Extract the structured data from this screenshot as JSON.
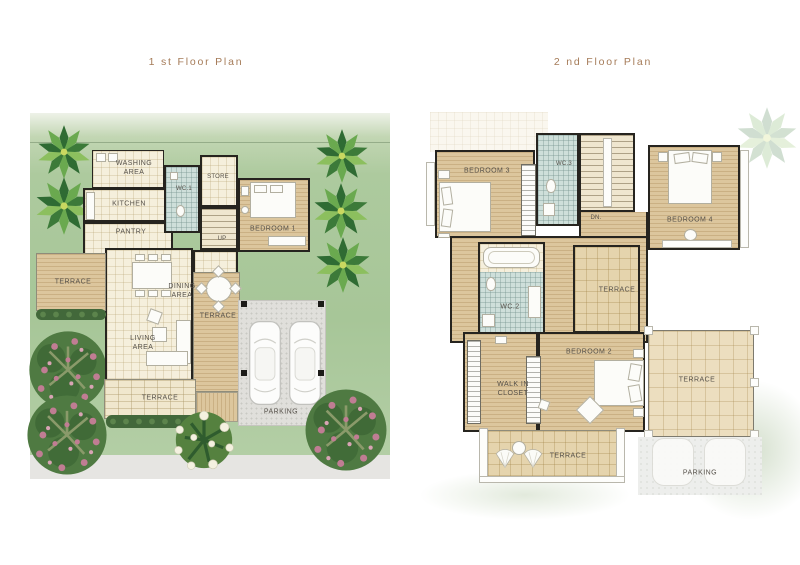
{
  "floor1": {
    "title": "1 st Floor Plan",
    "labels": {
      "washing": "WASHING\nAREA",
      "kitchen": "KITCHEN",
      "wc1": "WC.1",
      "store": "STORE",
      "up": "UP",
      "pantry": "PANTRY",
      "terrace_left": "TERRACE",
      "dining": "DINING\nAREA",
      "terrace_mid": "TERRACE",
      "living": "LIVING\nAREA",
      "bedroom1": "BEDROOM 1",
      "terrace_bottom": "TERRACE",
      "parking": "PARKING"
    }
  },
  "floor2": {
    "title": "2 nd Floor Plan",
    "labels": {
      "bedroom3": "BEDROOM 3",
      "wc3": "WC.3",
      "dn": "DN.",
      "bedroom4": "BEDROOM 4",
      "wc2": "WC.2",
      "terrace_mid": "TERRACE",
      "bedroom2": "BEDROOM 2",
      "walkin": "WALK IN\nCLOSET",
      "terrace_bottom": "TERRACE",
      "terrace_right": "TERRACE",
      "parking": "PARKING"
    }
  },
  "colors": {
    "title_text": "#a57b58",
    "label_text": "#56514a",
    "wall": "#26241f",
    "grass": "#a7c698",
    "floor_tile": "#f5efdc",
    "floor_wood": "#dcc69d",
    "floor_wc": "#cedfda",
    "paving": "#e0dfdb",
    "tree_green": "#4f7a42",
    "flower_pink": "#c07d93",
    "hedge_green": "#42683a"
  },
  "icons": {
    "trees": [
      "palm-tree-icon",
      "flowering-tree-icon",
      "white-flower-bush-icon"
    ],
    "furniture": [
      "bed-icon",
      "dining-table-icon",
      "sofa-icon",
      "round-table-icon",
      "car-icon",
      "bathtub-icon",
      "toilet-icon",
      "stairs-icon",
      "lounge-chair-icon"
    ]
  }
}
